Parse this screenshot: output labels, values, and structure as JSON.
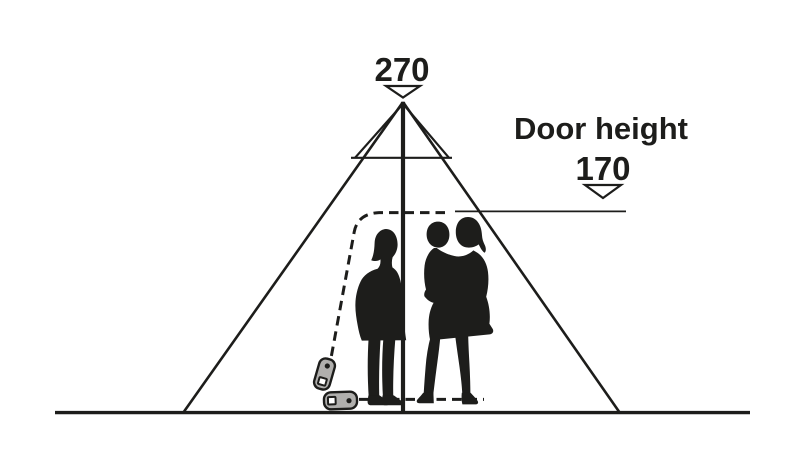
{
  "diagram": {
    "peak": {
      "value": "270"
    },
    "door": {
      "label": "Door height",
      "value": "170"
    }
  },
  "colors": {
    "ink": "#1d1d1b",
    "zipper_fill": "#b0afad",
    "background": "#ffffff"
  },
  "icons": {
    "peak_arrow": "open-triangle-down",
    "door_arrow": "open-triangle-down",
    "zipper_upper": "zipper-pull",
    "zipper_lower": "zipper-pull"
  }
}
